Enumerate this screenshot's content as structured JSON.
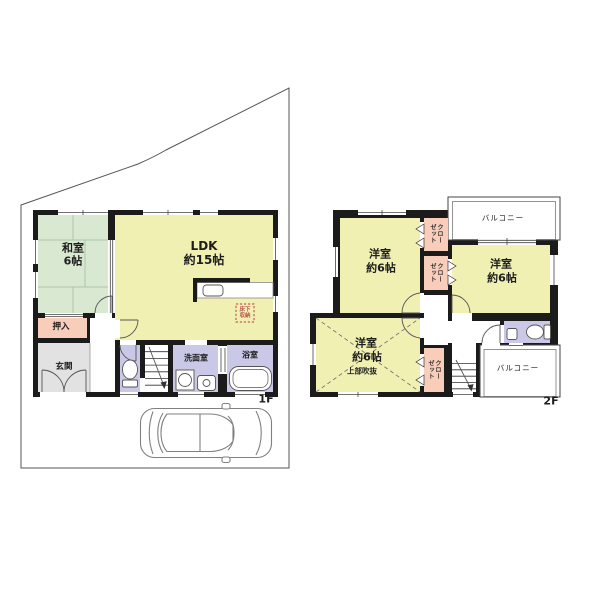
{
  "page": {
    "background": "#ffffff"
  },
  "floor1": {
    "label": "1F",
    "rooms": {
      "washitsu": {
        "name": "和室",
        "size": "6帖"
      },
      "ldk": {
        "name": "LDK",
        "size": "約15帖"
      },
      "oshiire": {
        "name": "押入"
      },
      "genkan": {
        "name": "玄関"
      },
      "senmenshitsu": {
        "name": "洗面室"
      },
      "yokushitsu": {
        "name": "浴室"
      },
      "floor_storage": {
        "line1": "床下",
        "line2": "収納"
      }
    }
  },
  "floor2": {
    "label": "2F",
    "rooms": {
      "yoshitsu1": {
        "name": "洋室",
        "size": "約6帖"
      },
      "yoshitsu2": {
        "name": "洋室",
        "size": "約6帖"
      },
      "yoshitsu3": {
        "name": "洋室",
        "size": "約6帖",
        "note": "上部吹抜"
      },
      "closet": {
        "name": "クローゼット"
      },
      "balcony_north": {
        "name": "バルコニー"
      },
      "balcony_south": {
        "name": "バルコニー"
      }
    }
  },
  "colors": {
    "wall": "#1b1b1b",
    "tatami_green": "#d9e8d1",
    "room_yellow": "#f0f0b3",
    "closet_pink": "#f8cdb9",
    "wet_area_lavender": "#c9c9e7",
    "genkan_gray": "#e2e2e2",
    "fukinuke_dash": "#777777",
    "storage_dash": "#c2605a"
  }
}
